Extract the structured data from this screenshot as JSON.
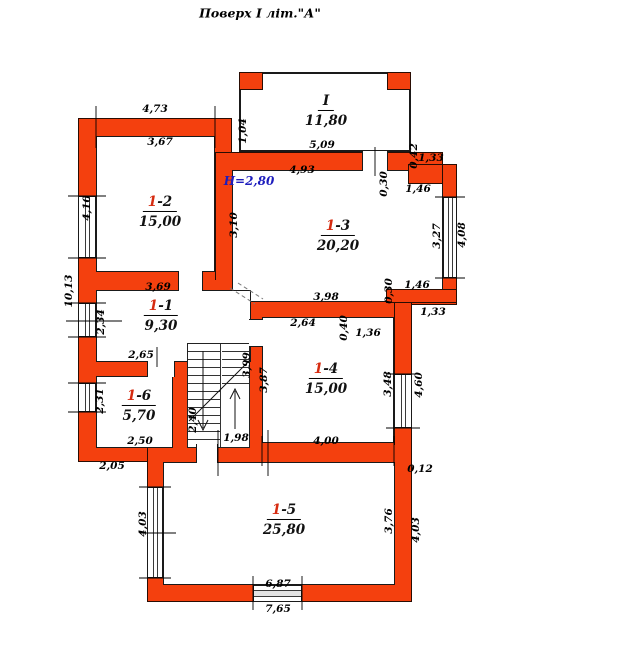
{
  "title": "Поверх І літ.\"А\"",
  "height_note": "Н=2,80",
  "colors": {
    "wall_orange": "#f4400e",
    "height_note_blue": "#1d1dbd",
    "room_number_red": "#d62b10"
  },
  "rooms": [
    {
      "name": "I",
      "area": "11,80"
    },
    {
      "num": "1",
      "suffix": "-2",
      "area": "15,00"
    },
    {
      "num": "1",
      "suffix": "-3",
      "area": "20,20"
    },
    {
      "num": "1",
      "suffix": "-1",
      "area": "9,30"
    },
    {
      "num": "1",
      "suffix": "-4",
      "area": "15,00"
    },
    {
      "num": "1",
      "suffix": "-6",
      "area": "5,70"
    },
    {
      "num": "1",
      "suffix": "-5",
      "area": "25,80"
    }
  ],
  "dims": {
    "top_w_out": "4,73",
    "top_w_in": "3,67",
    "porch_left": "1,04",
    "porch_w": "5,09",
    "r13_top": "4,93",
    "step_030_top": "0,30",
    "step_042": "0,42",
    "step_133_top": "1,33",
    "step_146_top": "1,46",
    "r12_left": "4,10",
    "r13_left": "3,10",
    "r13_right": "3,27",
    "right_out": "4,08",
    "r11_top": "3,69",
    "left_out": "10,13",
    "r11_win": "2,34",
    "r14_top_out": "3,98",
    "step_030_bot": "0,30",
    "step_146_bot": "1,46",
    "step_133_bot": "1,33",
    "r14_top_in": "2,64",
    "wall_040": "0,40",
    "r14_136": "1,36",
    "hall_399": "3,99",
    "hall_387": "3,87",
    "r16_top": "2,65",
    "r16_win": "2,31",
    "stair_240": "2,40",
    "stair_198": "1,98",
    "r14_right_in": "3,48",
    "r14_win": "4,60",
    "r16_bot": "2,50",
    "r16_out": "2,05",
    "r14_bot": "4,00",
    "corner_012": "0,12",
    "r15_left": "4,03",
    "r15_right_in": "3,76",
    "r15_right_out": "4,03",
    "r15_bot_in": "6,87",
    "r15_bot_out": "7,65"
  }
}
